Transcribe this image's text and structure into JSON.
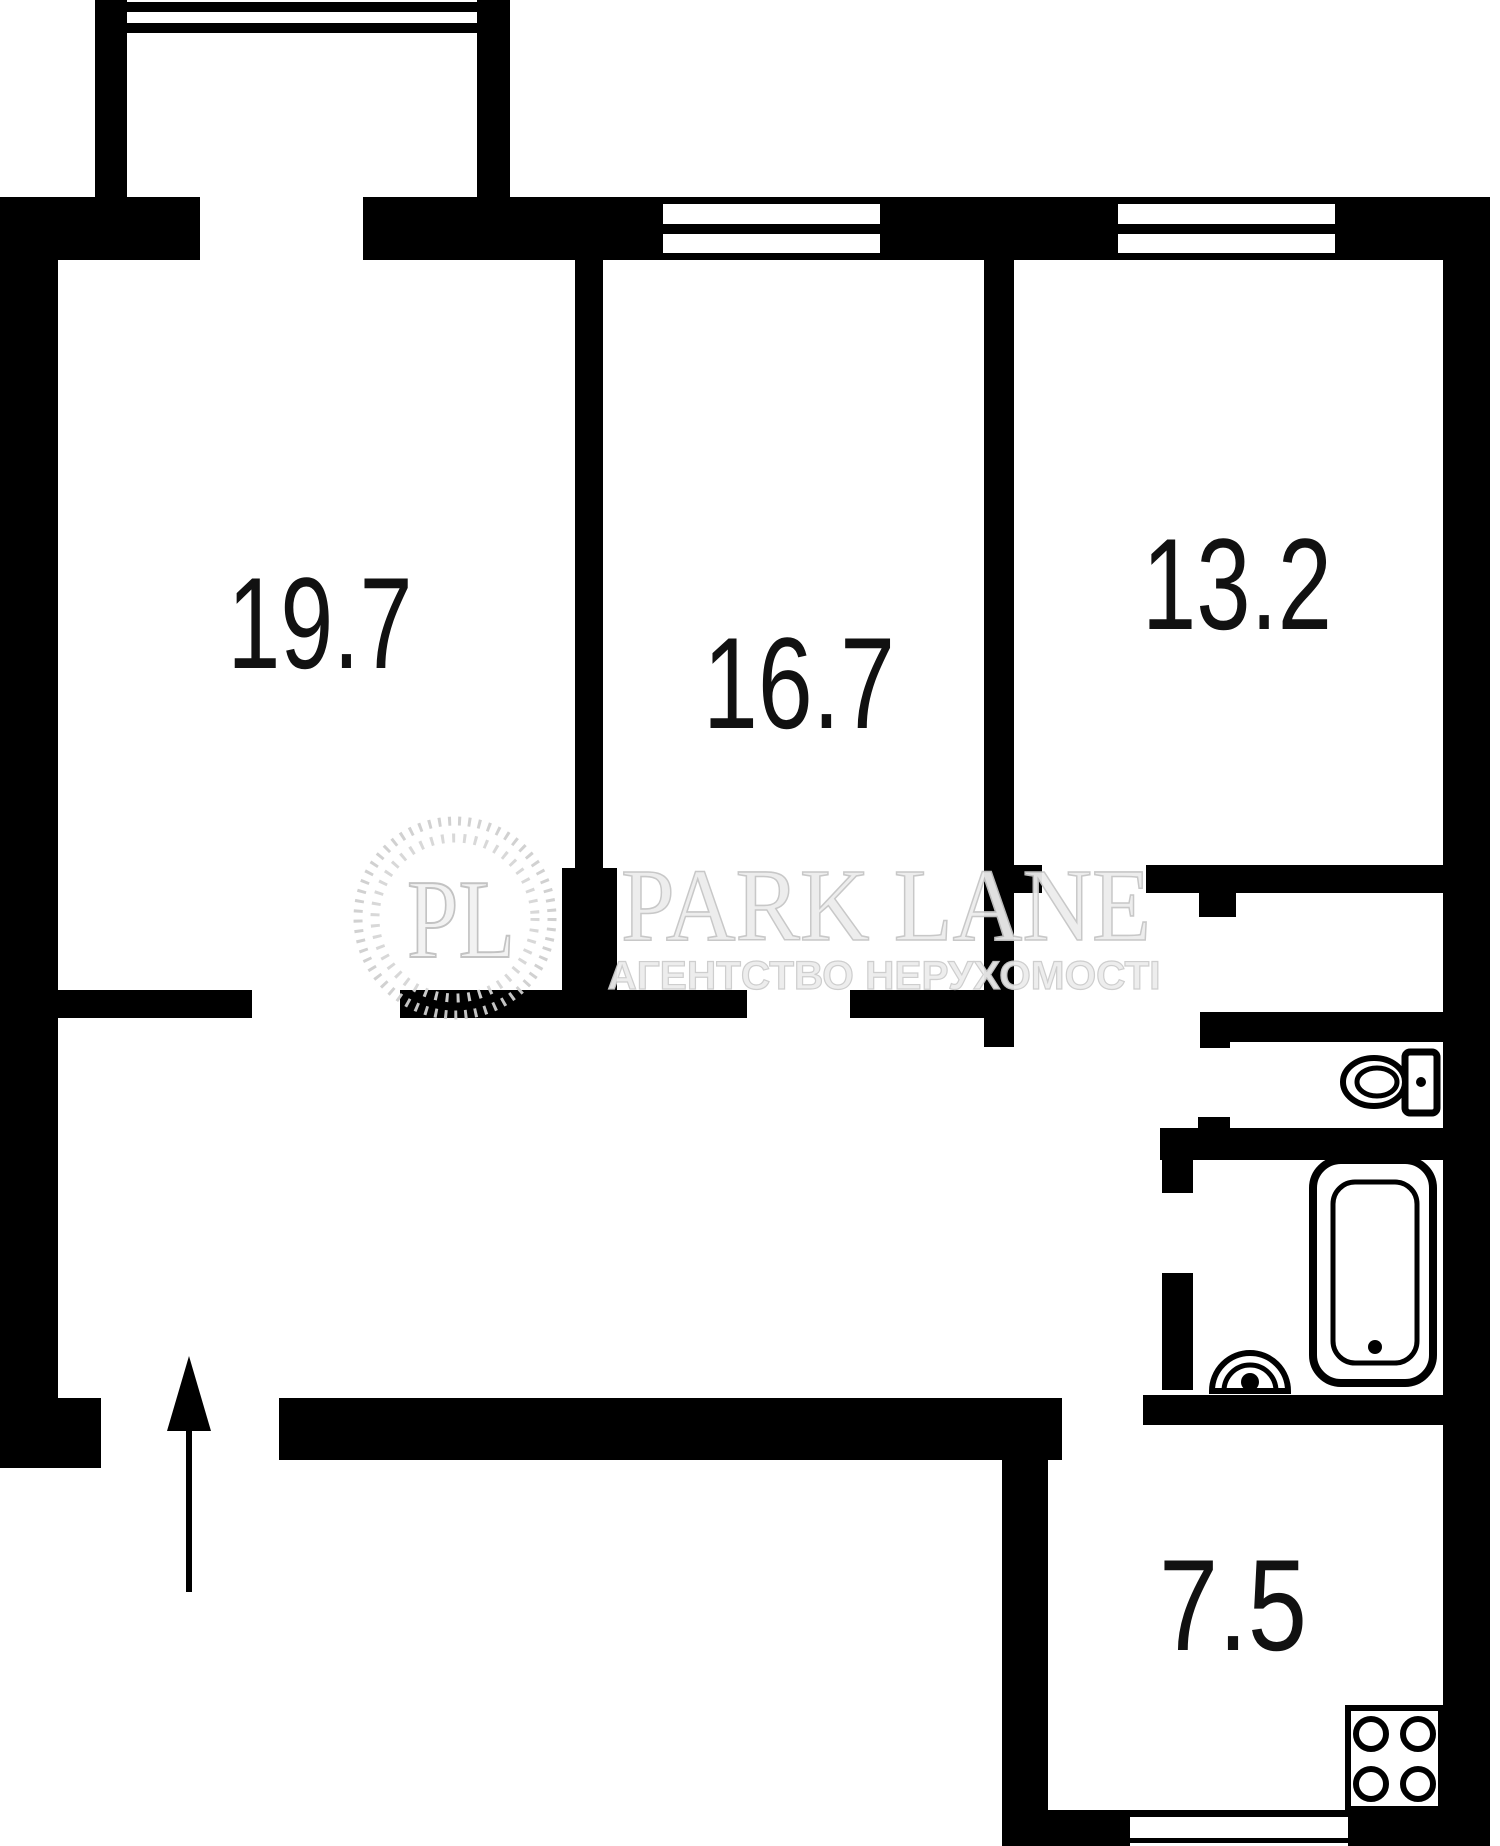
{
  "plan": {
    "type": "apartment-floor-plan",
    "colors": {
      "wall": "#000000",
      "background": "#ffffff",
      "label": "#111111",
      "watermark_fill": "#ededed",
      "watermark_stroke": "#c6c6c6"
    },
    "rooms": [
      {
        "name": "room-top-left",
        "area": "19.7"
      },
      {
        "name": "room-top-middle",
        "area": "16.7"
      },
      {
        "name": "room-top-right",
        "area": "13.2"
      },
      {
        "name": "kitchen",
        "area": "7.5"
      }
    ],
    "fixtures": [
      "balcony-window-icon",
      "double-window-icon",
      "toilet-icon",
      "bathtub-icon",
      "sink-icon",
      "stove-icon",
      "entrance-arrow-icon"
    ]
  },
  "watermark": {
    "initials": "PL",
    "brand": "PARK LANE",
    "tagline": "АГЕНТСТВО НЕРУХОМОСТІ"
  }
}
